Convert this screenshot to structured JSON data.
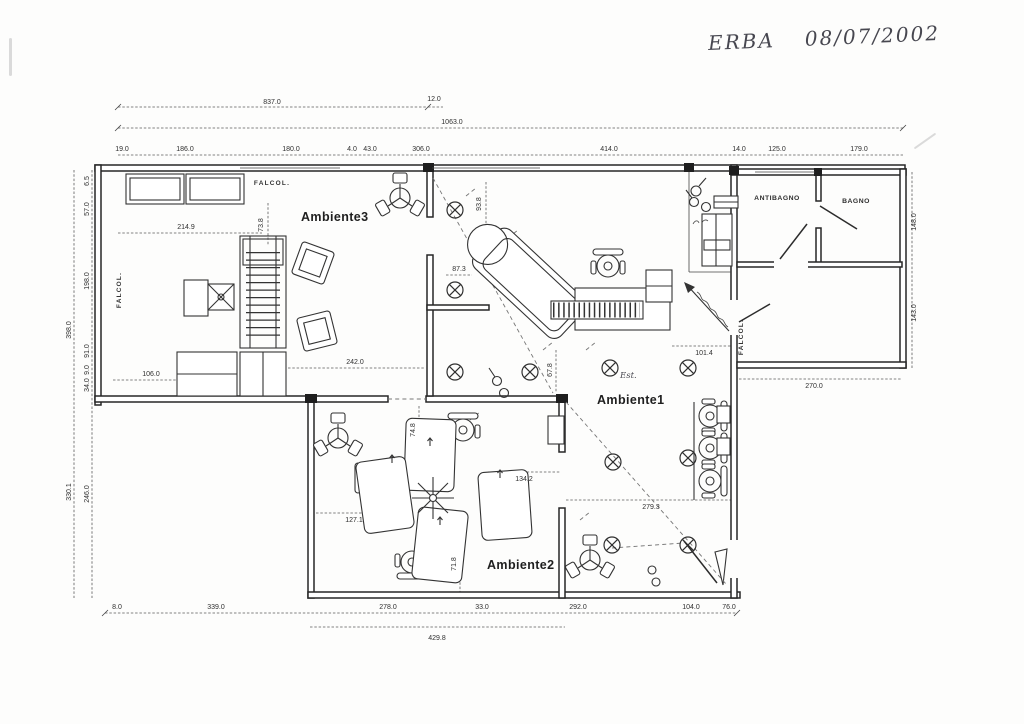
{
  "annotation": {
    "client": "ERBA",
    "date": "08/07/2002",
    "note_est": "Est."
  },
  "rooms": {
    "ambiente1": "Ambiente1",
    "ambiente2": "Ambiente2",
    "ambiente3": "Ambiente3",
    "antibagno": "ANTIBAGNO",
    "bagno": "BAGNO"
  },
  "wall_labels": {
    "top": "FALCOL.",
    "left": "FALCOL.",
    "wing": "FALCOL."
  },
  "colors": {
    "ink": "#262626",
    "paper": "#fdfdfc",
    "dim_text": "#2f2f2f"
  },
  "dims": {
    "width_top": [
      "837.0",
      "12.0"
    ],
    "width_total": "1063.0",
    "top_segments": [
      "19.0",
      "186.0",
      "180.0",
      "4.0",
      "43.0",
      "306.0",
      "414.0",
      "14.0",
      "125.0",
      "179.0"
    ],
    "left_outer": [
      "398.0",
      "330.1"
    ],
    "left_inner": [
      "6.5",
      "57.0",
      "198.0",
      "91.0",
      "9.0",
      "34.0",
      "246.0"
    ],
    "right_side": [
      "148.0",
      "143.0"
    ],
    "interior": {
      "amb3_desks": "214.9",
      "amb3_v": "73.8",
      "amb3_small": "106.0",
      "amb3_bottom": "242.0",
      "amb1_small": "87.3",
      "amb1_v": "93.8",
      "amb1_mid_v": "67.8",
      "amb1_desk": "101.4",
      "wing_bottom": "270.0",
      "amb2_left": "127.1",
      "amb2_mid": "134.2",
      "amb1_lower": "279.3",
      "amb2_v": "71.8",
      "amb2_top_v": "74.8"
    },
    "bottom_segments": [
      "8.0",
      "339.0",
      "278.0",
      "33.0",
      "292.0",
      "104.0",
      "76.0"
    ],
    "bottom_total": "429.8"
  }
}
